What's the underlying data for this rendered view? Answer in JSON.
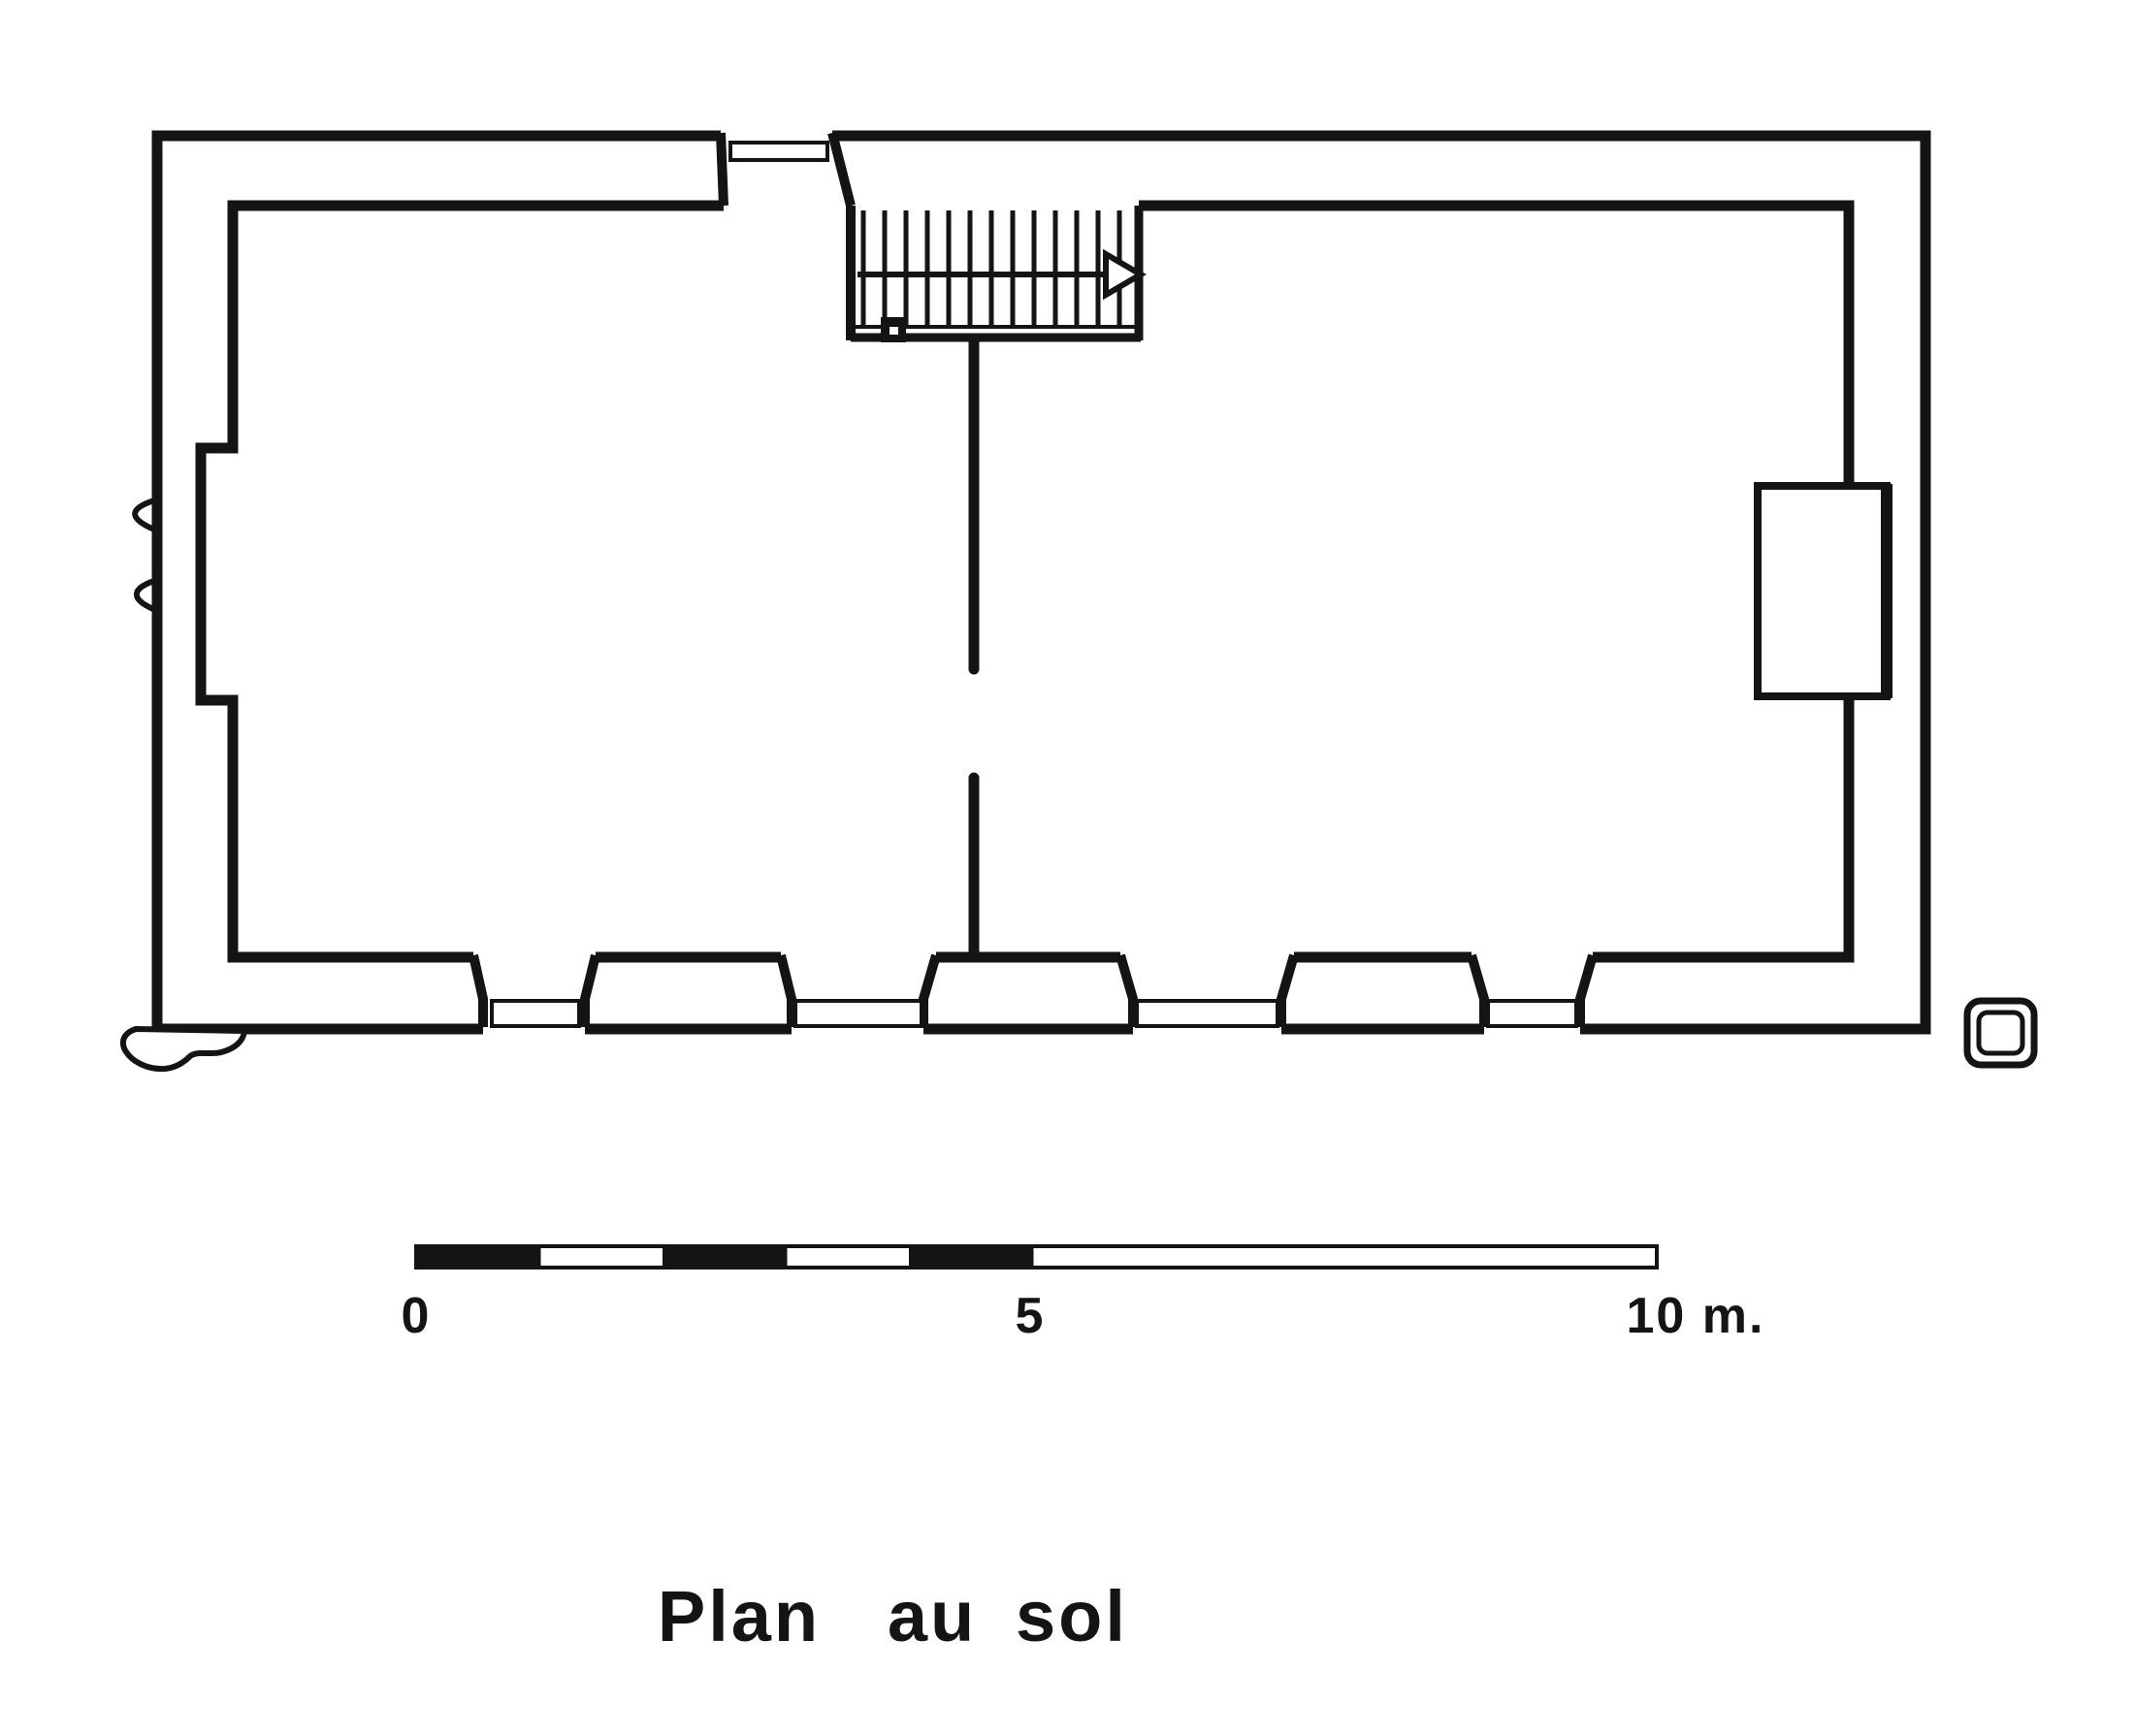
{
  "page": {
    "paper_color": "#ffffff",
    "ink_color": "#141414",
    "kind": "scanned architectural line drawing"
  },
  "title": {
    "text": "Plan au sol",
    "words": [
      "Plan",
      "au",
      "sol"
    ]
  },
  "scale_bar": {
    "unit": "m",
    "total_meters": 10,
    "labels": [
      {
        "text": "0",
        "meters": 0
      },
      {
        "text": "5",
        "meters": 5
      },
      {
        "text": "10 m.",
        "meters": 10
      }
    ],
    "segments_meters": [
      {
        "from": 0,
        "to": 1,
        "fill": "black"
      },
      {
        "from": 1,
        "to": 2,
        "fill": "white"
      },
      {
        "from": 2,
        "to": 3,
        "fill": "black"
      },
      {
        "from": 3,
        "to": 4,
        "fill": "white"
      },
      {
        "from": 4,
        "to": 5,
        "fill": "black"
      },
      {
        "from": 5,
        "to": 10,
        "fill": "white"
      }
    ]
  },
  "plan": {
    "features": [
      {
        "name": "outer-wall",
        "label": "thick rectangular outer wall"
      },
      {
        "name": "inner-wall",
        "label": "inner wall face with recess on left side"
      },
      {
        "name": "entrance-door",
        "label": "splayed door opening with threshold in top wall"
      },
      {
        "name": "staircase",
        "label": "straight stair flight, 13 treads, up-arrow to the right"
      },
      {
        "name": "partition-wall",
        "label": "central partition wall, drawn in two segments with gap"
      },
      {
        "name": "windows",
        "label": "four splayed window openings with sills in bottom wall",
        "count": 4
      },
      {
        "name": "chimney-niche",
        "label": "rectangular niche on inner right wall"
      },
      {
        "name": "wall-marks",
        "label": "two small chevron marks outside left wall"
      },
      {
        "name": "boulder",
        "label": "irregular stone outline at outer south-west corner"
      },
      {
        "name": "corner-marker",
        "label": "small double-outline rounded square south-east of plan"
      }
    ]
  }
}
